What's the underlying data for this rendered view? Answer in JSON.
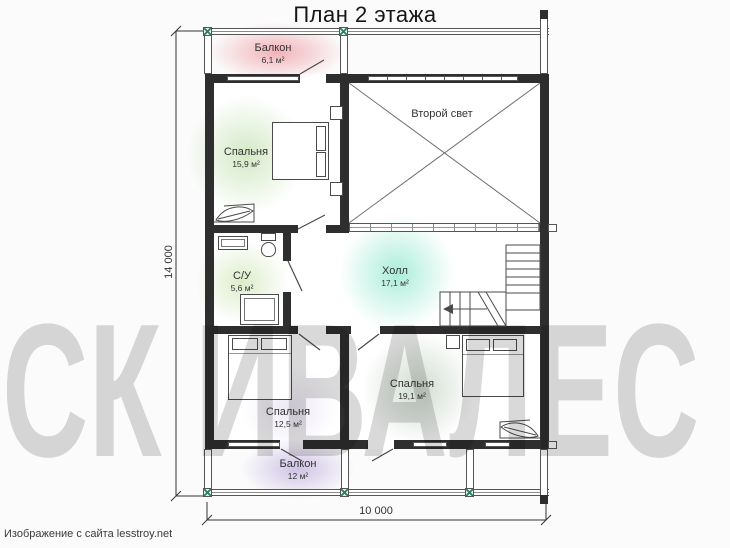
{
  "title": "План 2 этажа",
  "watermark": "СК ИВАЛЕС",
  "attribution": "Изображение с сайта lesstroy.net",
  "dimensions": {
    "vertical": "14 000",
    "horizontal": "10 000"
  },
  "rooms": {
    "balcony_top": {
      "name": "Балкон",
      "area": "6,1 м²"
    },
    "bedroom_top": {
      "name": "Спальня",
      "area": "15,9 м²"
    },
    "second_light": {
      "name": "Второй свет",
      "area": ""
    },
    "bathroom": {
      "name": "С/У",
      "area": "5,6 м²"
    },
    "hall": {
      "name": "Холл",
      "area": "17,1 м²"
    },
    "bedroom_left": {
      "name": "Спальня",
      "area": "12,5 м²"
    },
    "bedroom_right": {
      "name": "Спальня",
      "area": "19,1 м²"
    },
    "balcony_bottom": {
      "name": "Балкон",
      "area": "12 м²"
    }
  },
  "colors": {
    "bg": "#fbfbfb",
    "wall": "#2e2e2e",
    "line": "#555555",
    "text": "#333333",
    "marker_green": "#2e8060",
    "watermark": "#d9d9d9",
    "blob_pink": "rgba(233,118,130,0.55)",
    "blob_green": "rgba(158,205,128,0.45)",
    "blob_bath_green": "rgba(178,215,138,0.45)",
    "blob_mint": "rgba(115,225,193,0.60)",
    "blob_lavender_light": "rgba(190,175,220,0.28)",
    "blob_gray_green": "rgba(163,185,163,0.50)",
    "blob_purple": "rgba(162,138,208,0.50)"
  }
}
